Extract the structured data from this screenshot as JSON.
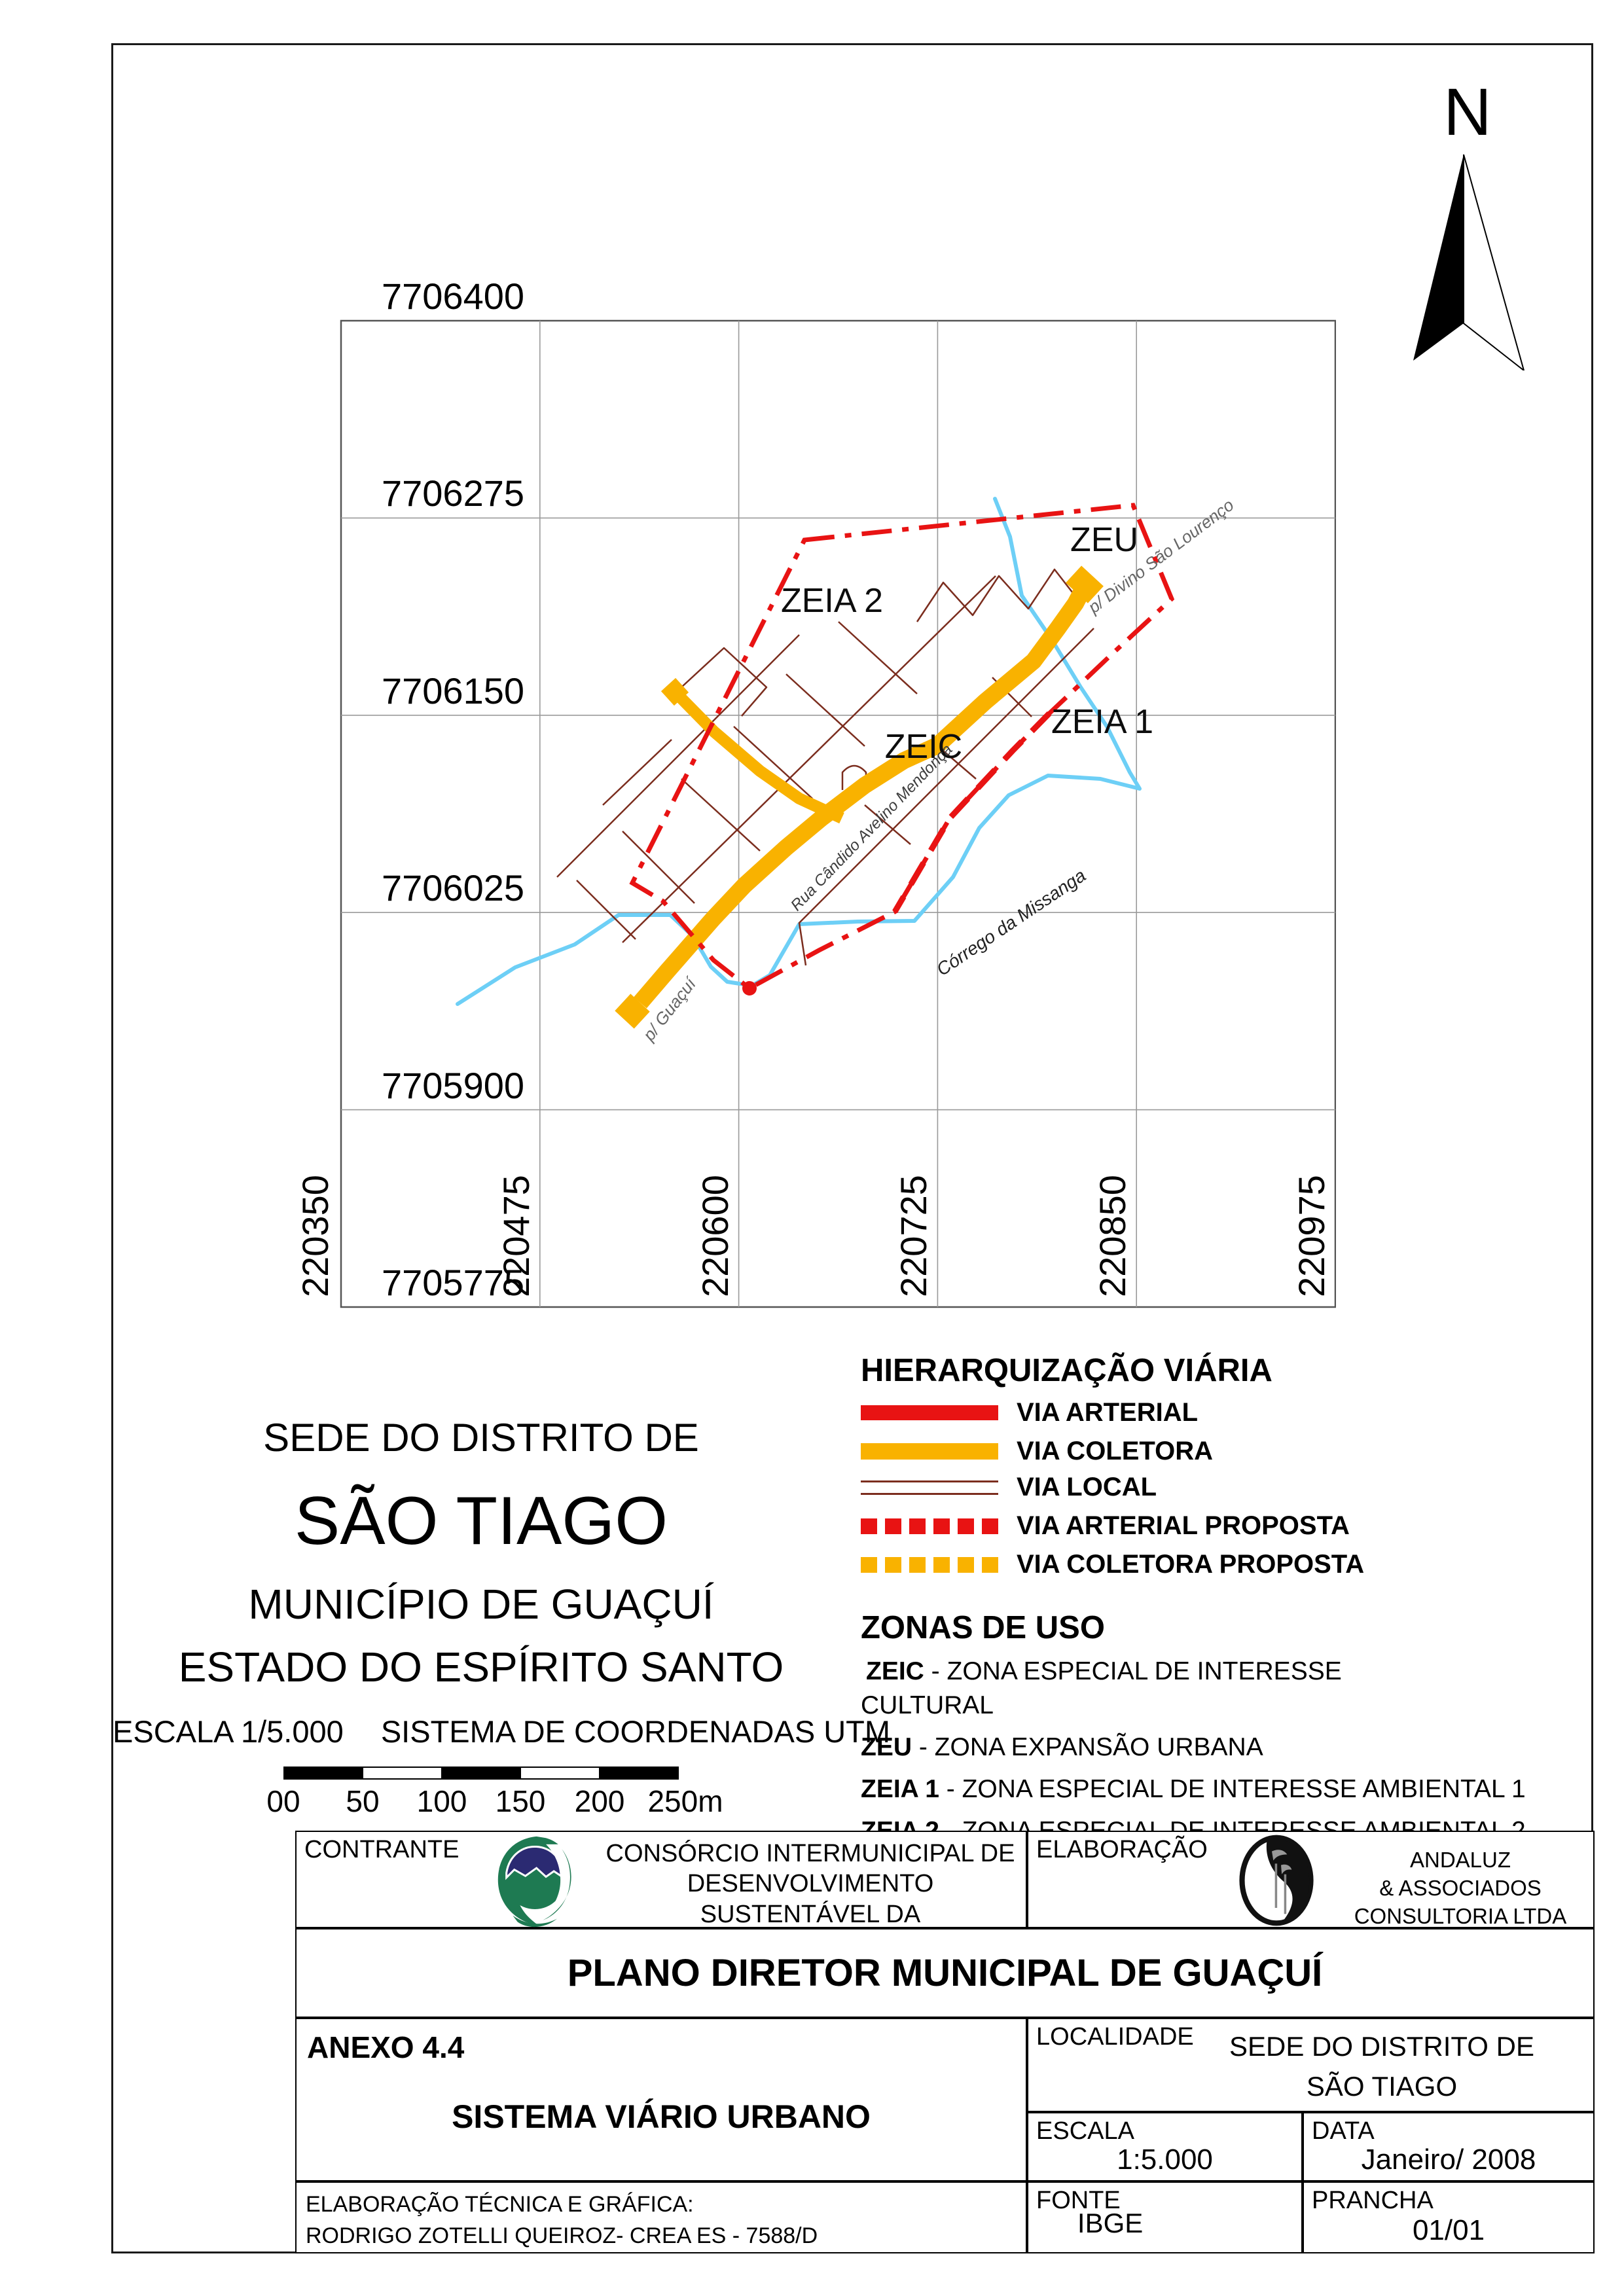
{
  "compass": {
    "label": "N"
  },
  "map": {
    "y_axis_labels": [
      "7706400",
      "7706275",
      "7706150",
      "7706025",
      "7705900",
      "7705775"
    ],
    "x_axis_labels": [
      "220350",
      "220475",
      "220600",
      "220725",
      "220850",
      "220975"
    ],
    "zones": {
      "zeia2": "ZEIA 2",
      "zeu": "ZEU",
      "zeic": "ZEIC",
      "zeia1": "ZEIA 1"
    },
    "roads": {
      "rua": "Rua Cândido Avelino Mendonça",
      "divino": "p/ Divino São Lourenço",
      "guacui": "p/ Guaçuí",
      "corrego": "Córrego da Missanga"
    }
  },
  "map_title": {
    "line1": "SEDE DO DISTRITO DE",
    "line2": "SÃO TIAGO",
    "line3": "MUNICÍPIO DE GUAÇUÍ",
    "line4": "ESTADO DO ESPÍRITO SANTO",
    "scale": "ESCALA 1/5.000",
    "coords": "SISTEMA DE COORDENADAS UTM",
    "scalebar_labels": [
      "00",
      "50",
      "100",
      "150",
      "200",
      "250m"
    ]
  },
  "legend": {
    "title": "HIERARQUIZAÇÃO VIÁRIA",
    "items": [
      {
        "label": "VIA ARTERIAL",
        "style": "solid",
        "color": "#E81313"
      },
      {
        "label": "VIA COLETORA",
        "style": "solid",
        "color": "#F9B200"
      },
      {
        "label": "VIA LOCAL",
        "style": "double-line",
        "color": "#7B2D1E"
      },
      {
        "label": "VIA ARTERIAL PROPOSTA",
        "style": "dashed",
        "color": "#E81313"
      },
      {
        "label": "VIA COLETORA PROPOSTA",
        "style": "dashed",
        "color": "#F9B200"
      }
    ],
    "zones_title": "ZONAS DE USO",
    "zones": [
      {
        "code": "ZEIC",
        "desc": " - ZONA ESPECIAL DE INTERESSE",
        "line2": "CULTURAL"
      },
      {
        "code": "ZEU",
        "desc": " - ZONA EXPANSÃO URBANA"
      },
      {
        "code": "ZEIA 1",
        "desc": " - ZONA ESPECIAL DE INTERESSE AMBIENTAL 1"
      },
      {
        "code": "ZEIA 2",
        "desc": " - ZONA ESPECIAL DE INTERESSE AMBIENTAL 2"
      }
    ],
    "limit": "LIMITE DO PERÍMETRO URBANO"
  },
  "colors": {
    "via_arterial": "#E81313",
    "via_coletora": "#F9B200",
    "via_local": "#7B2D1E",
    "stream": "#6DCFF6"
  },
  "title_block": {
    "contratante_label": "CONTRANTE",
    "contratante_line1": "CONSÓRCIO INTERMUNICIPAL DE",
    "contratante_line2": "DESENVOLVIMENTO SUSTENTÁVEL DA",
    "contratante_line3": "REGIÃO DO CAPARAÓ",
    "elaboracao_label": "ELABORAÇÃO",
    "elaboracao_line1": "ANDALUZ",
    "elaboracao_line2": "& ASSOCIADOS",
    "elaboracao_line3": "CONSULTORIA LTDA",
    "plan_title": "PLANO DIRETOR MUNICIPAL DE GUAÇUÍ",
    "anexo": "ANEXO 4.4",
    "sheet_subtitle": "SISTEMA VIÁRIO URBANO",
    "localidade_label": "LOCALIDADE",
    "localidade_line1": "SEDE DO DISTRITO DE",
    "localidade_line2": "SÃO TIAGO",
    "escala_label": "ESCALA",
    "escala_value": "1:5.000",
    "data_label": "DATA",
    "data_value": "Janeiro/ 2008",
    "tecnica_line1": "ELABORAÇÃO TÉCNICA E GRÁFICA:",
    "tecnica_line2": "RODRIGO ZOTELLI QUEIROZ- CREA ES - 7588/D",
    "fonte_label": "FONTE",
    "fonte_value": "IBGE",
    "prancha_label": "PRANCHA",
    "prancha_value": "01/01"
  }
}
